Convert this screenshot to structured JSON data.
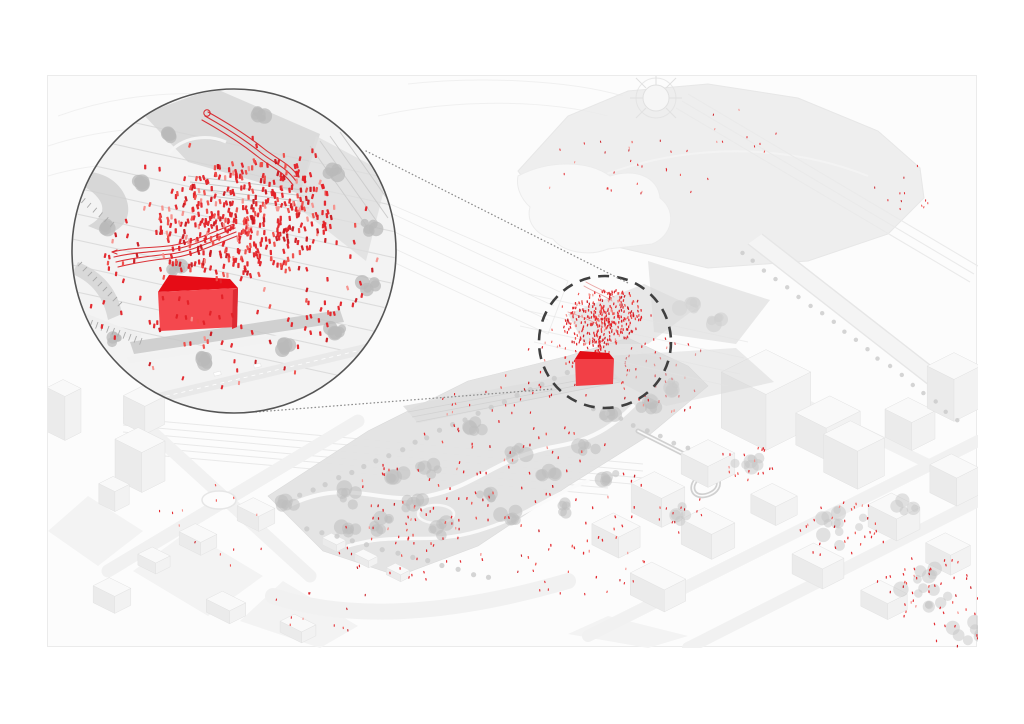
{
  "meta": {
    "description": "Axonometric urban site diagram: grey isometric city with linear park; a dashed focus circle around a red gabled pavilion and red crowd, magnified in a large circular inset at top-left connected by dotted leader lines.",
    "seed": 20
  },
  "colors": {
    "page_bg": "#ffffff",
    "canvas_bg": "#fcfcfc",
    "canvas_border": "#ebebeb",
    "context_line": "#f0f0f0",
    "stripe": "#d6d6d6",
    "park_base": "#e3e3e3",
    "plaza_gray": "#d5d5d5",
    "tree_gray": "#bdbdbd",
    "hedge_gray": "#c8c8c8",
    "bld_top": "#f9f9f9",
    "bld_right": "#f2f2f2",
    "bld_left": "#ebebeb",
    "bld_stroke": "#e2e2e2",
    "inset_bg": "#f3f3f3",
    "inset_ring": "#555555",
    "focus_dash": "#3f3f3f",
    "connector": "#8c8c8c",
    "red_ribbon": "#d8262c",
    "house_roof": "#e60c16",
    "house_face": "#f4484e",
    "house_side": "#de2b33",
    "focus_house_roof": "#e30d16",
    "focus_house_face": "#f23f46"
  },
  "people": {
    "palette": [
      "#e32127",
      "#ef4b47",
      "#c9161d",
      "#f58f8a"
    ],
    "weights": [
      0.55,
      0.2,
      0.15,
      0.1
    ]
  },
  "inset": {
    "cx": 186,
    "cy": 175,
    "r": 162,
    "crowd": {
      "cx": 196,
      "cy": 143,
      "rx": 92,
      "ry": 60,
      "count": 400,
      "w": 2.3,
      "h": 5.2,
      "rot": -12,
      "bias": 0.62
    },
    "halo": {
      "cx": 190,
      "cy": 165,
      "rx": 148,
      "ry": 106,
      "count": 80,
      "w": 2.2,
      "h": 4.8,
      "rot": 0,
      "bias": 1
    },
    "regions": [
      {
        "cx": 200,
        "cy": 248,
        "rx": 95,
        "ry": 28,
        "count": 24,
        "w": 2.2,
        "h": 4.6
      },
      {
        "cx": 78,
        "cy": 212,
        "rx": 38,
        "ry": 52,
        "count": 13,
        "w": 2.2,
        "h": 4.6
      },
      {
        "cx": 284,
        "cy": 212,
        "rx": 44,
        "ry": 55,
        "count": 15,
        "w": 2.2,
        "h": 4.6
      },
      {
        "cx": 170,
        "cy": 296,
        "rx": 80,
        "ry": 16,
        "count": 10,
        "w": 2.0,
        "h": 4.2
      }
    ]
  },
  "focus": {
    "cx": 557,
    "cy": 266,
    "r": 66,
    "dash": "11 8",
    "stroke_width": 2.6,
    "crowd": {
      "cx": 555,
      "cy": 243,
      "rx": 41,
      "ry": 28,
      "count": 300,
      "w": 1.25,
      "h": 2.7,
      "rot": -18,
      "bias": 0.62
    },
    "funnel": {
      "cx": 552,
      "cy": 272,
      "rx": 14,
      "ry": 19,
      "count": 45,
      "w": 1.2,
      "h": 2.6,
      "rot": 0,
      "bias": 0.8
    },
    "regions": [
      {
        "cx": 557,
        "cy": 266,
        "rx": 60,
        "ry": 54,
        "count": 30,
        "w": 1.1,
        "h": 2.4
      }
    ]
  },
  "connectors": [
    {
      "x1": 318,
      "y1": 75,
      "x2": 580,
      "y2": 207
    },
    {
      "x1": 208,
      "y1": 336,
      "x2": 505,
      "y2": 313
    }
  ],
  "scatter_regions": [
    {
      "cx": 455,
      "cy": 420,
      "rx": 150,
      "ry": 75,
      "count": 110,
      "s": 1.15
    },
    {
      "cx": 350,
      "cy": 468,
      "rx": 70,
      "ry": 40,
      "count": 38,
      "s": 1.1
    },
    {
      "cx": 500,
      "cy": 300,
      "rx": 55,
      "ry": 32,
      "count": 26,
      "s": 1.05
    },
    {
      "cx": 612,
      "cy": 300,
      "rx": 58,
      "ry": 40,
      "count": 42,
      "s": 1.1
    },
    {
      "cx": 585,
      "cy": 95,
      "rx": 95,
      "ry": 36,
      "count": 28,
      "s": 0.95
    },
    {
      "cx": 700,
      "cy": 55,
      "rx": 60,
      "ry": 24,
      "count": 10,
      "s": 0.9
    },
    {
      "cx": 868,
      "cy": 120,
      "rx": 48,
      "ry": 34,
      "count": 12,
      "s": 0.9
    },
    {
      "cx": 795,
      "cy": 455,
      "rx": 48,
      "ry": 30,
      "count": 32,
      "s": 1.1
    },
    {
      "cx": 878,
      "cy": 512,
      "rx": 56,
      "ry": 32,
      "count": 40,
      "s": 1.1
    },
    {
      "cx": 925,
      "cy": 553,
      "rx": 45,
      "ry": 22,
      "count": 18,
      "s": 1.1
    },
    {
      "cx": 700,
      "cy": 387,
      "rx": 30,
      "ry": 17,
      "count": 18,
      "s": 1.1
    },
    {
      "cx": 530,
      "cy": 495,
      "rx": 75,
      "ry": 26,
      "count": 20,
      "s": 1.0
    },
    {
      "cx": 160,
      "cy": 452,
      "rx": 70,
      "ry": 45,
      "count": 13,
      "s": 1.0
    },
    {
      "cx": 262,
      "cy": 532,
      "rx": 75,
      "ry": 28,
      "count": 11,
      "s": 1.0
    },
    {
      "cx": 430,
      "cy": 335,
      "rx": 60,
      "ry": 22,
      "count": 15,
      "s": 1.0
    },
    {
      "cx": 640,
      "cy": 440,
      "rx": 35,
      "ry": 18,
      "count": 12,
      "s": 1.0
    }
  ],
  "context": {
    "buildings_left": [
      {
        "cx": 16,
        "cy": 356,
        "a": 10,
        "b": 9,
        "h": 44
      },
      {
        "cx": 96,
        "cy": 348,
        "a": 12,
        "b": 11,
        "h": 28
      },
      {
        "cx": 92,
        "cy": 404,
        "a": 15,
        "b": 13,
        "h": 40
      },
      {
        "cx": 66,
        "cy": 428,
        "a": 9,
        "b": 8,
        "h": 20
      },
      {
        "cx": 150,
        "cy": 470,
        "a": 12,
        "b": 9,
        "h": 13
      },
      {
        "cx": 106,
        "cy": 490,
        "a": 10,
        "b": 8,
        "h": 11
      },
      {
        "cx": 208,
        "cy": 446,
        "a": 12,
        "b": 9,
        "h": 15
      },
      {
        "cx": 64,
        "cy": 528,
        "a": 12,
        "b": 9,
        "h": 17
      },
      {
        "cx": 178,
        "cy": 538,
        "a": 13,
        "b": 9,
        "h": 13
      },
      {
        "cx": 250,
        "cy": 558,
        "a": 12,
        "b": 8,
        "h": 11
      }
    ],
    "buildings_right": [
      {
        "cx": 718,
        "cy": 352,
        "a": 25,
        "b": 25,
        "h": 56
      },
      {
        "cx": 780,
        "cy": 368,
        "a": 17,
        "b": 19,
        "h": 32
      },
      {
        "cx": 660,
        "cy": 398,
        "a": 15,
        "b": 15,
        "h": 21
      },
      {
        "cx": 610,
        "cy": 438,
        "a": 17,
        "b": 13,
        "h": 29
      },
      {
        "cx": 568,
        "cy": 470,
        "a": 15,
        "b": 12,
        "h": 21
      },
      {
        "cx": 660,
        "cy": 470,
        "a": 17,
        "b": 13,
        "h": 25
      },
      {
        "cx": 726,
        "cy": 438,
        "a": 14,
        "b": 12,
        "h": 19
      },
      {
        "cx": 806,
        "cy": 398,
        "a": 19,
        "b": 15,
        "h": 38
      },
      {
        "cx": 862,
        "cy": 362,
        "a": 15,
        "b": 13,
        "h": 28
      },
      {
        "cx": 906,
        "cy": 332,
        "a": 15,
        "b": 15,
        "h": 42
      },
      {
        "cx": 846,
        "cy": 452,
        "a": 16,
        "b": 13,
        "h": 22
      },
      {
        "cx": 906,
        "cy": 418,
        "a": 15,
        "b": 12,
        "h": 28
      },
      {
        "cx": 770,
        "cy": 500,
        "a": 17,
        "b": 12,
        "h": 20
      },
      {
        "cx": 836,
        "cy": 532,
        "a": 15,
        "b": 11,
        "h": 16
      },
      {
        "cx": 900,
        "cy": 488,
        "a": 14,
        "b": 11,
        "h": 20
      },
      {
        "cx": 610,
        "cy": 522,
        "a": 19,
        "b": 12,
        "h": 22
      }
    ],
    "park_huts": [
      {
        "cx": 286,
        "cy": 470,
        "a": 8,
        "b": 5,
        "h": 7
      },
      {
        "cx": 318,
        "cy": 486,
        "a": 8,
        "b": 5,
        "h": 7
      },
      {
        "cx": 350,
        "cy": 500,
        "a": 8,
        "b": 5,
        "h": 7
      }
    ],
    "tree_clumps": [
      {
        "cx": 300,
        "cy": 420,
        "r": 13
      },
      {
        "cx": 332,
        "cy": 445,
        "r": 14
      },
      {
        "cx": 366,
        "cy": 428,
        "r": 11
      },
      {
        "cx": 395,
        "cy": 455,
        "r": 12
      },
      {
        "cx": 300,
        "cy": 455,
        "r": 10
      },
      {
        "cx": 432,
        "cy": 420,
        "r": 12
      },
      {
        "cx": 462,
        "cy": 440,
        "r": 11
      },
      {
        "cx": 500,
        "cy": 396,
        "r": 12
      },
      {
        "cx": 470,
        "cy": 378,
        "r": 9
      },
      {
        "cx": 540,
        "cy": 370,
        "r": 10
      },
      {
        "cx": 562,
        "cy": 342,
        "r": 9
      },
      {
        "cx": 430,
        "cy": 352,
        "r": 9
      },
      {
        "cx": 380,
        "cy": 392,
        "r": 10
      },
      {
        "cx": 350,
        "cy": 402,
        "r": 9
      },
      {
        "cx": 520,
        "cy": 430,
        "r": 10
      },
      {
        "cx": 562,
        "cy": 400,
        "r": 9
      },
      {
        "cx": 602,
        "cy": 330,
        "r": 9
      },
      {
        "cx": 625,
        "cy": 310,
        "r": 8
      },
      {
        "cx": 640,
        "cy": 230,
        "r": 9
      },
      {
        "cx": 668,
        "cy": 244,
        "r": 8
      },
      {
        "cx": 240,
        "cy": 428,
        "r": 9
      }
    ],
    "courtyard_clumps": [
      {
        "cx": 795,
        "cy": 452,
        "r": 26
      },
      {
        "cx": 878,
        "cy": 510,
        "r": 30
      },
      {
        "cx": 925,
        "cy": 552,
        "r": 22
      },
      {
        "cx": 700,
        "cy": 385,
        "r": 15
      },
      {
        "cx": 860,
        "cy": 430,
        "r": 12
      },
      {
        "cx": 636,
        "cy": 438,
        "r": 12
      }
    ],
    "inset_trees": [
      {
        "cx": 122,
        "cy": 57,
        "r": 9
      },
      {
        "cx": 210,
        "cy": 40,
        "r": 7
      },
      {
        "cx": 288,
        "cy": 96,
        "r": 8
      },
      {
        "cx": 322,
        "cy": 150,
        "r": 9
      },
      {
        "cx": 318,
        "cy": 208,
        "r": 10
      },
      {
        "cx": 288,
        "cy": 252,
        "r": 9
      },
      {
        "cx": 236,
        "cy": 272,
        "r": 8
      },
      {
        "cx": 156,
        "cy": 284,
        "r": 8
      },
      {
        "cx": 66,
        "cy": 262,
        "r": 7
      },
      {
        "cx": 58,
        "cy": 152,
        "r": 6
      },
      {
        "cx": 130,
        "cy": 192,
        "r": 7
      },
      {
        "cx": 96,
        "cy": 106,
        "r": 7
      }
    ],
    "tree_rows": [
      {
        "x1": 252,
        "y1": 420,
        "x2": 520,
        "y2": 296,
        "step": 14,
        "r": 2.6
      },
      {
        "x1": 258,
        "y1": 452,
        "x2": 440,
        "y2": 502,
        "step": 15,
        "r": 2.6
      },
      {
        "x1": 694,
        "y1": 176,
        "x2": 910,
        "y2": 344,
        "step": 14,
        "r": 2.2
      },
      {
        "x1": 545,
        "y1": 332,
        "x2": 640,
        "y2": 372,
        "step": 13,
        "r": 2.4
      }
    ],
    "tick_rows": [
      {
        "x1": 28,
        "y1": 238,
        "x2": 94,
        "y2": 262,
        "n": 13,
        "len": 7
      },
      {
        "x1": 34,
        "y1": 186,
        "x2": 74,
        "y2": 226,
        "n": 9,
        "len": 6
      },
      {
        "x1": 20,
        "y1": 108,
        "x2": 66,
        "y2": 146,
        "n": 9,
        "len": 6
      }
    ]
  }
}
